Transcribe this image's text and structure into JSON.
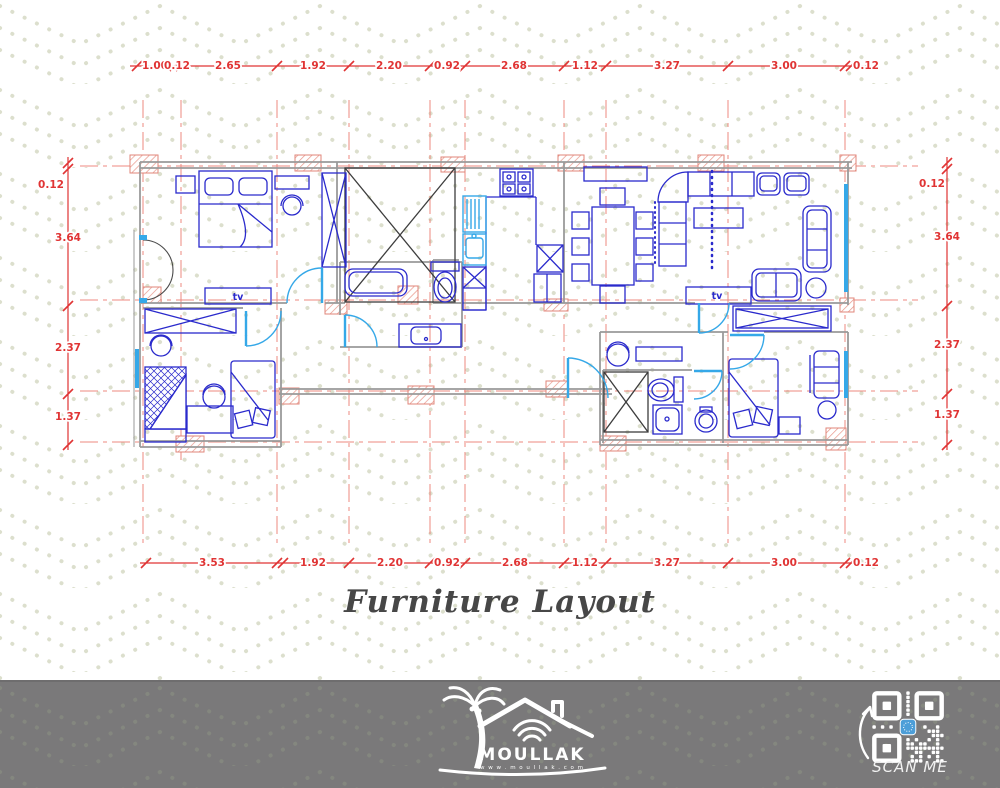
{
  "title": {
    "text": "Furniture Layout"
  },
  "plan": {
    "tv_label": "tv"
  },
  "dimensions": {
    "top": {
      "labels": [
        {
          "t": "1.00",
          "x": 155,
          "y": 69
        },
        {
          "t": "0.12",
          "x": 177,
          "y": 69
        },
        {
          "t": "2.65",
          "x": 228,
          "y": 69
        },
        {
          "t": "1.92",
          "x": 313,
          "y": 69
        },
        {
          "t": "2.20",
          "x": 389,
          "y": 69
        },
        {
          "t": "0.92",
          "x": 447,
          "y": 69
        },
        {
          "t": "2.68",
          "x": 514,
          "y": 69
        },
        {
          "t": "1.12",
          "x": 585,
          "y": 69
        },
        {
          "t": "3.27",
          "x": 667,
          "y": 69
        },
        {
          "t": "3.00",
          "x": 784,
          "y": 69
        },
        {
          "t": "0.12",
          "x": 866,
          "y": 69
        }
      ]
    },
    "bottom": {
      "labels": [
        {
          "t": "3.53",
          "x": 212,
          "y": 566
        },
        {
          "t": "1.92",
          "x": 313,
          "y": 566
        },
        {
          "t": "2.20",
          "x": 390,
          "y": 566
        },
        {
          "t": "0.92",
          "x": 447,
          "y": 566
        },
        {
          "t": "2.68",
          "x": 515,
          "y": 566
        },
        {
          "t": "1.12",
          "x": 585,
          "y": 566
        },
        {
          "t": "3.27",
          "x": 667,
          "y": 566
        },
        {
          "t": "3.00",
          "x": 784,
          "y": 566
        },
        {
          "t": "0.12",
          "x": 866,
          "y": 566
        }
      ]
    },
    "left": {
      "labels": [
        {
          "t": "0.12",
          "x": 51,
          "y": 188
        },
        {
          "t": "3.64",
          "x": 68,
          "y": 241
        },
        {
          "t": "2.37",
          "x": 68,
          "y": 351
        },
        {
          "t": "1.37",
          "x": 68,
          "y": 420
        }
      ]
    },
    "right": {
      "labels": [
        {
          "t": "0.12",
          "x": 932,
          "y": 187
        },
        {
          "t": "3.64",
          "x": 947,
          "y": 240
        },
        {
          "t": "2.37",
          "x": 947,
          "y": 348
        },
        {
          "t": "1.37",
          "x": 947,
          "y": 418
        }
      ]
    }
  },
  "footer": {
    "brand": "MOULLAK",
    "website": "w w w . m o u l l a k . c o m",
    "scan_me": "SCAN ME"
  },
  "colors": {
    "dim_red": "#e03434",
    "grid_red": "#ed7d72",
    "furniture_blue": "#2a2acc",
    "accent_cyan": "#35a8e8",
    "wall_gray": "#9a9a9a",
    "footer_gray": "#7a797a",
    "chevron_dot": "#dcdfcd",
    "qr_icon_blue": "#4d9ed8"
  }
}
